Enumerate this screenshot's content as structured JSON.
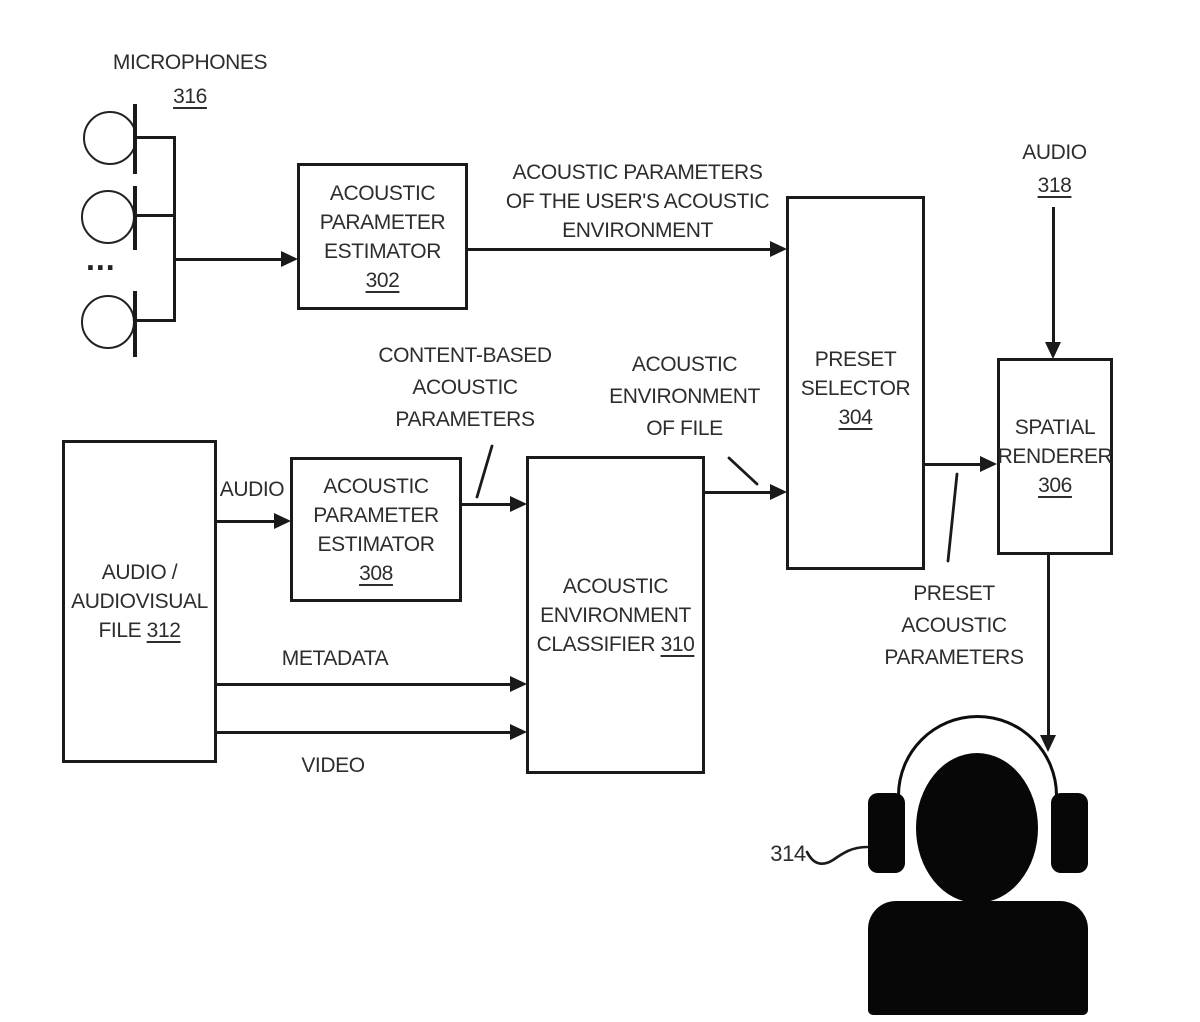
{
  "figure": {
    "nodes": {
      "microphones": {
        "label": "MICROPHONES",
        "ref": "316",
        "dots": "..."
      },
      "estimator302": {
        "l1": "ACOUSTIC",
        "l2": "PARAMETER",
        "l3": "ESTIMATOR",
        "ref": "302"
      },
      "preset304": {
        "l1": "PRESET",
        "l2": "SELECTOR",
        "ref": "304"
      },
      "spatial306": {
        "l1": "SPATIAL",
        "l2": "RENDERER",
        "ref": "306"
      },
      "file312": {
        "l1": "AUDIO /",
        "l2": "AUDIOVISUAL",
        "l3": "FILE",
        "ref": "312"
      },
      "estimator308": {
        "l1": "ACOUSTIC",
        "l2": "PARAMETER",
        "l3": "ESTIMATOR",
        "ref": "308"
      },
      "classifier310": {
        "l1": "ACOUSTIC",
        "l2": "ENVIRONMENT",
        "l3": "CLASSIFIER",
        "ref": "310"
      },
      "audio318": {
        "label": "AUDIO",
        "ref": "318"
      },
      "listener": {
        "ref": "314"
      }
    },
    "edge_labels": {
      "user_env": {
        "l1": "ACOUSTIC PARAMETERS",
        "l2": "OF THE USER'S ACOUSTIC",
        "l3": "ENVIRONMENT"
      },
      "content_based": {
        "l1": "CONTENT-BASED",
        "l2": "ACOUSTIC",
        "l3": "PARAMETERS"
      },
      "env_of_file": {
        "l1": "ACOUSTIC",
        "l2": "ENVIRONMENT",
        "l3": "OF FILE"
      },
      "preset_params": {
        "l1": "PRESET",
        "l2": "ACOUSTIC",
        "l3": "PARAMETERS"
      },
      "audio": "AUDIO",
      "metadata": "METADATA",
      "video": "VIDEO"
    },
    "colors": {
      "line": "#1a1a1a",
      "text": "#2d2d2d",
      "background": "#ffffff",
      "silhouette": "#070707"
    }
  }
}
